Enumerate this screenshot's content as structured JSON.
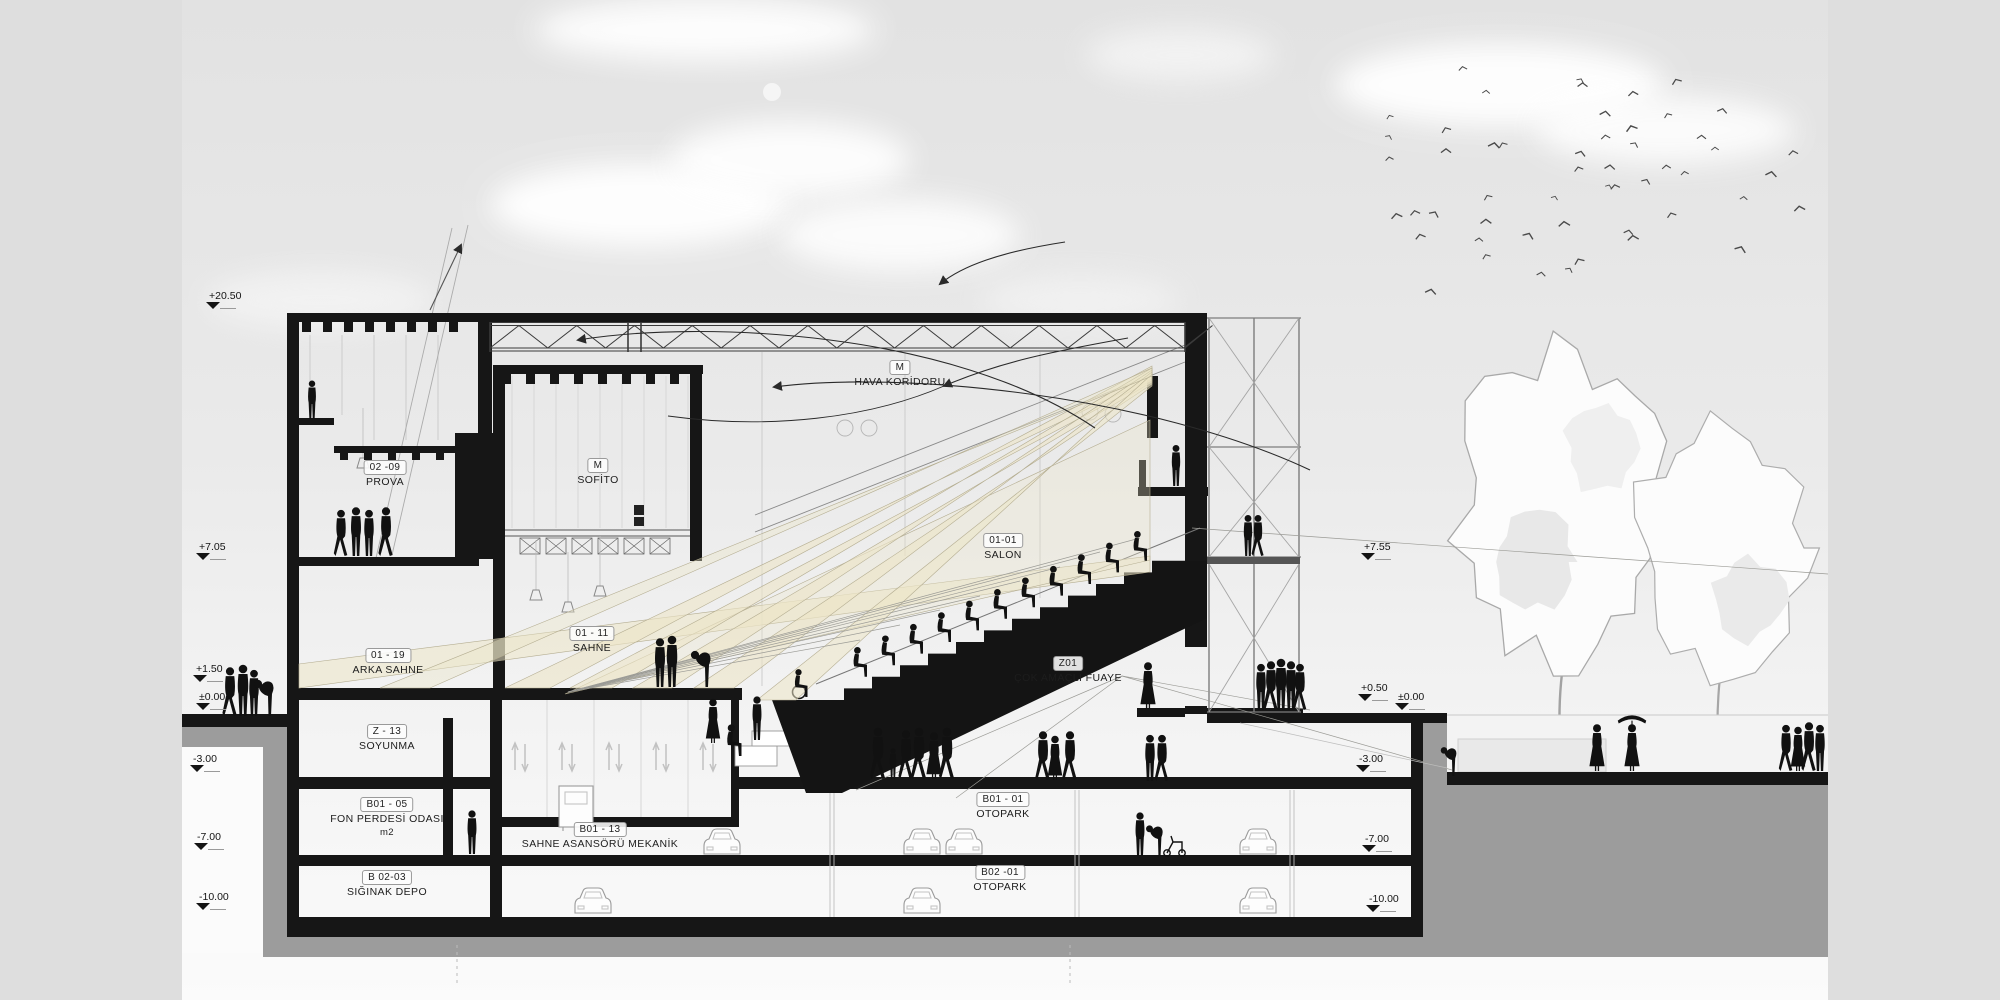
{
  "scene": {
    "background": "#dedede",
    "sky_top": "#e3e3e3",
    "sky_bottom": "#fbfbfb",
    "ink": "#161616",
    "earth_color": "#9c9c9c",
    "beam_fill": "#ece5c7",
    "beam_edge": "#b5ae92"
  },
  "elevation_markers": [
    {
      "id": "left-20-50",
      "value": "+20.50",
      "x": 222,
      "y": 290,
      "side": "left"
    },
    {
      "id": "left-7-05",
      "value": "+7.05",
      "x": 212,
      "y": 541,
      "side": "left"
    },
    {
      "id": "left-1-50",
      "value": "+1.50",
      "x": 209,
      "y": 663,
      "side": "left"
    },
    {
      "id": "left-0-00",
      "value": "±0.00",
      "x": 212,
      "y": 691,
      "side": "left"
    },
    {
      "id": "left-m3-00",
      "value": "-3.00",
      "x": 206,
      "y": 753,
      "side": "left"
    },
    {
      "id": "left-m7-00",
      "value": "-7.00",
      "x": 210,
      "y": 831,
      "side": "left"
    },
    {
      "id": "left-m10-00",
      "value": "-10.00",
      "x": 212,
      "y": 891,
      "side": "left"
    },
    {
      "id": "right-7-55",
      "value": "+7.55",
      "x": 1377,
      "y": 541,
      "side": "right"
    },
    {
      "id": "right-0-50",
      "value": "+0.50",
      "x": 1374,
      "y": 682,
      "side": "right"
    },
    {
      "id": "right-0-00",
      "value": "±0.00",
      "x": 1411,
      "y": 691,
      "side": "right"
    },
    {
      "id": "right-m3-00",
      "value": "-3.00",
      "x": 1372,
      "y": 753,
      "side": "right"
    },
    {
      "id": "right-m7-00",
      "value": "-7.00",
      "x": 1378,
      "y": 833,
      "side": "right"
    },
    {
      "id": "right-m10-00",
      "value": "-10.00",
      "x": 1382,
      "y": 893,
      "side": "right"
    }
  ],
  "room_labels": [
    {
      "id": "prova",
      "code": "02 -09",
      "name": "PROVA",
      "x": 385,
      "y": 460
    },
    {
      "id": "sofito",
      "code": "M",
      "name": "SOFİTO",
      "x": 598,
      "y": 458
    },
    {
      "id": "hava-koridoru",
      "code": "M",
      "name": "HAVA KORİDORU",
      "x": 900,
      "y": 360
    },
    {
      "id": "salon",
      "code": "01-01",
      "name": "SALON",
      "x": 1003,
      "y": 533
    },
    {
      "id": "arka-sahne",
      "code": "01 - 19",
      "name": "ARKA SAHNE",
      "x": 388,
      "y": 648
    },
    {
      "id": "sahne",
      "code": "01 - 11",
      "name": "SAHNE",
      "x": 592,
      "y": 626
    },
    {
      "id": "fuaye",
      "code": "Z01",
      "name": "ÇOK AMAÇLI FUAYE",
      "x": 1068,
      "y": 656
    },
    {
      "id": "soyunma",
      "code": "Z - 13",
      "name": "SOYUNMA",
      "x": 387,
      "y": 724
    },
    {
      "id": "fon-perdesi",
      "code": "B01 - 05",
      "name": "FON PERDESİ ODASI",
      "note": "m2",
      "x": 387,
      "y": 797
    },
    {
      "id": "sahne-asansoru",
      "code": "B01 - 13",
      "name": "SAHNE ASANSÖRÜ MEKANİK",
      "x": 600,
      "y": 822
    },
    {
      "id": "siginak",
      "code": "B 02-03",
      "name": "SIĞINAK DEPO",
      "x": 387,
      "y": 870
    },
    {
      "id": "otopark-b1",
      "code": "B01 - 01",
      "name": "OTOPARK",
      "x": 1003,
      "y": 792
    },
    {
      "id": "otopark-b2",
      "code": "B02 -01",
      "name": "OTOPARK",
      "x": 1000,
      "y": 865
    }
  ]
}
